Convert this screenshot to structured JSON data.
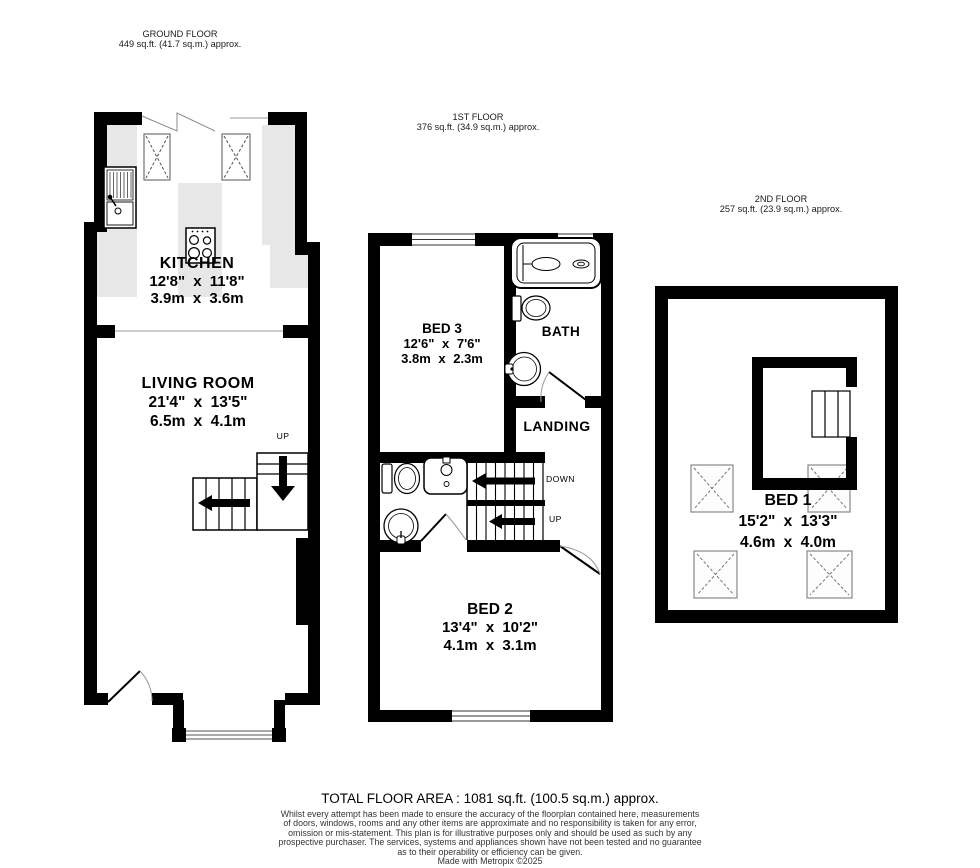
{
  "floors": {
    "ground": {
      "title": "GROUND FLOOR",
      "area": "449 sq.ft. (41.7 sq.m.) approx.",
      "kitchen": {
        "name": "KITCHEN",
        "imperial": "12'8\" x 11'8\"",
        "metric": "3.9m x 3.6m"
      },
      "living_room": {
        "name": "LIVING ROOM",
        "imperial": "21'4\" x 13'5\"",
        "metric": "6.5m x 4.1m"
      },
      "stairs_up_label": "UP"
    },
    "first": {
      "title": "1ST FLOOR",
      "area": "376 sq.ft. (34.9 sq.m.) approx.",
      "bed3": {
        "name": "BED 3",
        "imperial": "12'6\" x 7'6\"",
        "metric": "3.8m x 2.3m"
      },
      "bath_label": "BATH",
      "landing_label": "LANDING",
      "bed2": {
        "name": "BED 2",
        "imperial": "13'4\" x 10'2\"",
        "metric": "4.1m x 3.1m"
      },
      "stairs_down_label": "DOWN",
      "stairs_up_label": "UP"
    },
    "second": {
      "title": "2ND FLOOR",
      "area": "257 sq.ft. (23.9 sq.m.) approx.",
      "bed1": {
        "name": "BED 1",
        "imperial": "15'2\" x 13'3\"",
        "metric": "4.6m x 4.0m"
      }
    }
  },
  "footer": {
    "total_area": "TOTAL FLOOR AREA : 1081 sq.ft. (100.5 sq.m.) approx.",
    "disclaimer_lines": [
      "Whilst every attempt has been made to ensure the accuracy of the floorplan contained here, measurements",
      "of doors, windows, rooms and any other items are approximate and no responsibility is taken for any error,",
      "omission or mis-statement. This plan is for illustrative purposes only and should be used as such by any",
      "prospective purchaser. The services, systems and appliances shown have not been tested and no guarantee",
      "as to their operability or efficiency can be given."
    ],
    "credit": "Made with Metropix ©2025"
  }
}
